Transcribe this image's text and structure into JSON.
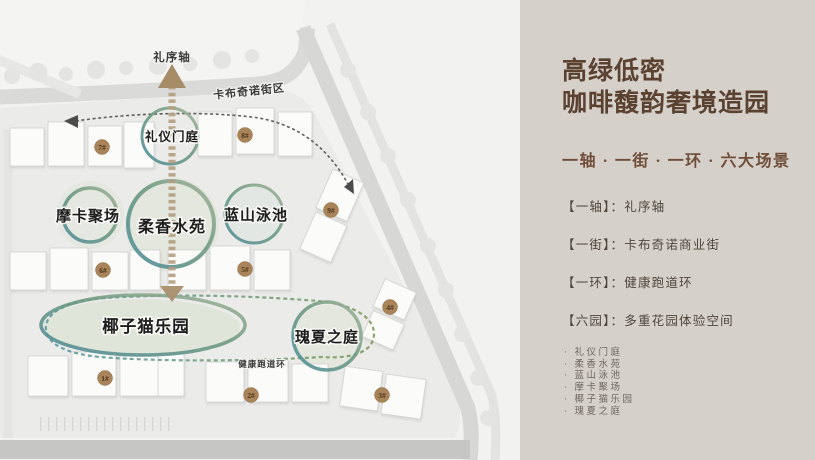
{
  "panel": {
    "title_line1": "高绿低密",
    "title_line2": "咖啡馥韵奢境造园",
    "subtitle": "一轴 · 一街 · 一环 · 六大场景",
    "features": [
      "【一轴】：礼序轴",
      "【一街】：卡布奇诺商业街",
      "【一环】：健康跑道环",
      "【六园】：多重花园体验空间"
    ],
    "gardens": [
      "· 礼仪门庭",
      "· 柔香水苑",
      "· 蓝山泳池",
      "· 摩卡聚场",
      "· 椰子猫乐园",
      "· 瑰夏之庭"
    ]
  },
  "map": {
    "axis_label": "礼序轴",
    "street_label": "卡布奇诺街区",
    "loop_label": "健康跑道环",
    "zone_labels": [
      "礼仪门庭",
      "摩卡聚场",
      "柔香水苑",
      "蓝山泳池",
      "椰子猫乐园",
      "瑰夏之庭"
    ],
    "badges": [
      "7#",
      "8#",
      "9#",
      "6#",
      "5#",
      "4#",
      "1#",
      "2#",
      "3#"
    ]
  },
  "colors": {
    "panel_bg": "#d6d0ca",
    "title_brown": "#5a4130",
    "map_bg": "#f1f1ef",
    "circle_teal": "#4f8d9c",
    "circle_olive": "#7f9b72",
    "circle_sage": "#a3b49b",
    "axis_tan": "#b29d7f",
    "badge_brown": "#a9835a",
    "loop_teal": "#5b98a8",
    "loop_green": "#7f9b5f"
  }
}
